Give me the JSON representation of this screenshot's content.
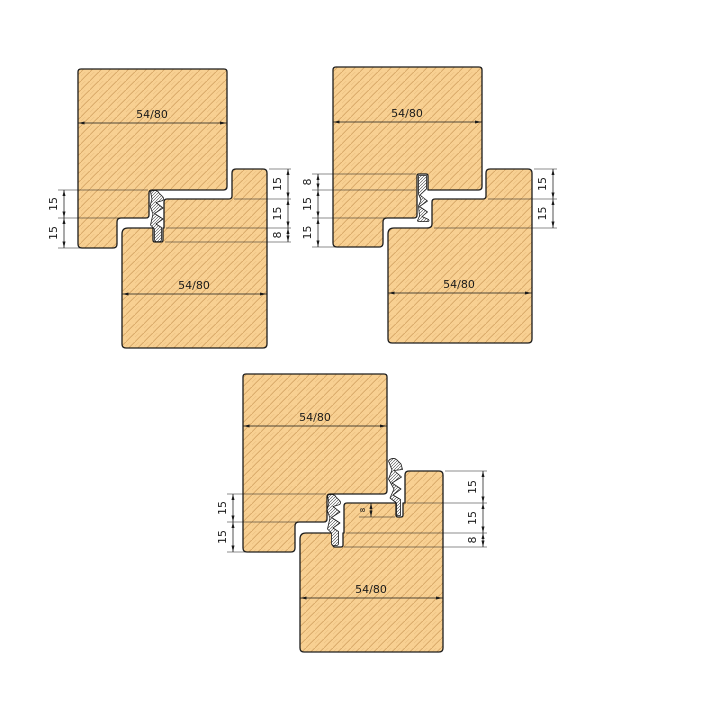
{
  "drawing_type": "timber frame rebate joint cross-sections with weatherseal gaskets",
  "colors": {
    "bg": "#ffffff",
    "wood_fill": "#f8d092",
    "wood_grain": "#d3a261",
    "outline": "#1c1c1c",
    "dim": "#1a1a1a",
    "seal_bg": "#ffffff",
    "seal_hatch": "#3a3a3a"
  },
  "diagrams": [
    {
      "name": "top-left",
      "dim_top": "54/80",
      "dim_bottom": "54/80",
      "left_dims": [
        "15",
        "15"
      ],
      "right_dims": [
        "15",
        "15",
        "8"
      ]
    },
    {
      "name": "top-right",
      "dim_top": "54/80",
      "dim_bottom": "54/80",
      "left_dims": [
        "8",
        "15",
        "15"
      ],
      "right_dims": [
        "15",
        "15"
      ]
    },
    {
      "name": "bottom-center",
      "dim_top": "54/80",
      "dim_bottom": "54/80",
      "left_dims": [
        "15",
        "15"
      ],
      "right_dims": [
        "15",
        "15",
        "8"
      ],
      "seal_groove_dim": "8"
    }
  ]
}
